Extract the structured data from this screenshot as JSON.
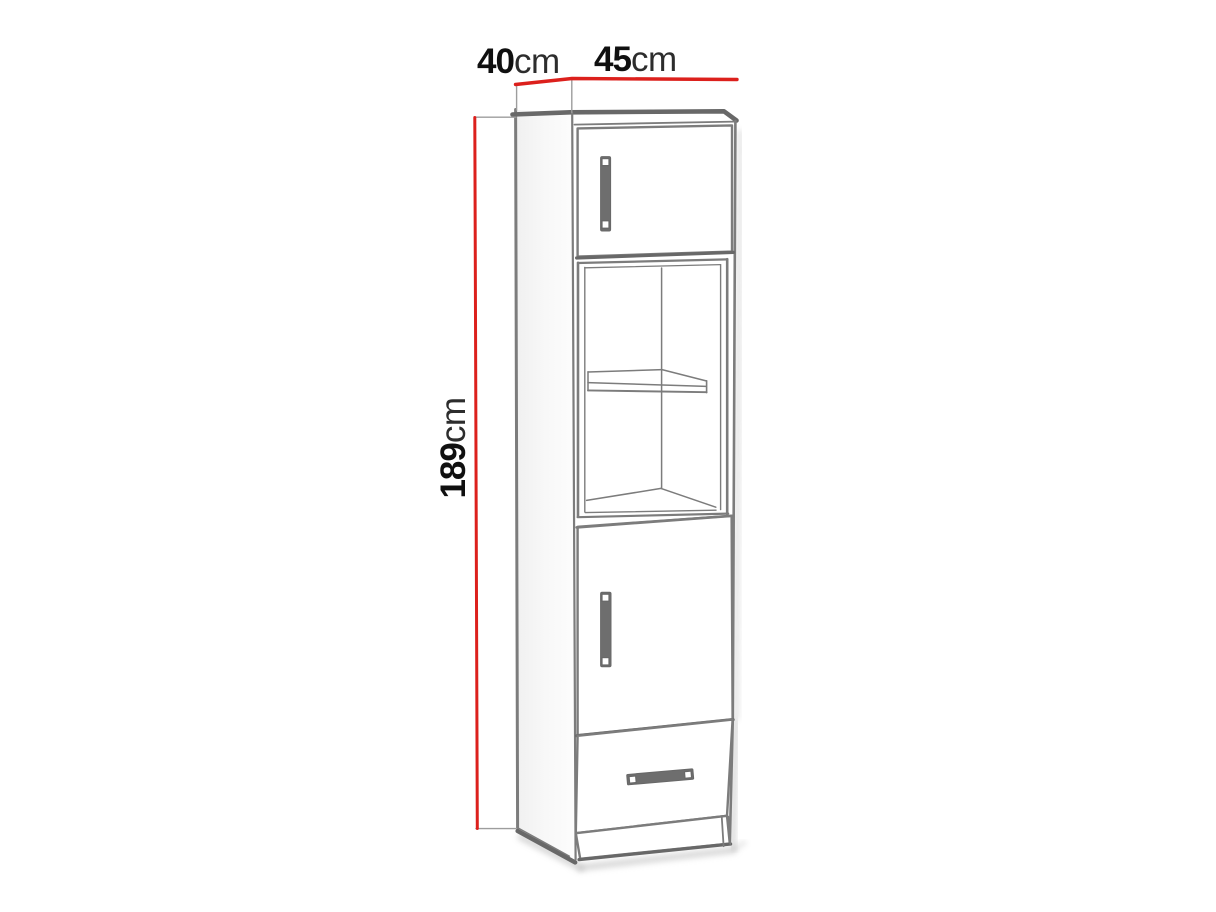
{
  "page": {
    "description": "technical-dimension-drawing",
    "subject": "tall-single-column-cabinet"
  },
  "labels": {
    "depth": {
      "value": "40",
      "unit": "cm"
    },
    "width": {
      "value": "45",
      "unit": "cm"
    },
    "height": {
      "value": "189",
      "unit": "cm"
    }
  },
  "parts": [
    "top-door",
    "shelf-niche",
    "middle-shelf",
    "lower-door",
    "drawer",
    "plinth"
  ],
  "colors": {
    "dimension_line": "#dc201c",
    "sketch_line": "#7c7c7c",
    "sketch_line_dark": "#686868",
    "sketch_line_light": "#9d9d9d",
    "handle_fill": "#6e6e6e",
    "label_value": "#101010",
    "label_unit": "#2d2d2d",
    "shadow": "#bdbdbd",
    "background": "#ffffff"
  }
}
